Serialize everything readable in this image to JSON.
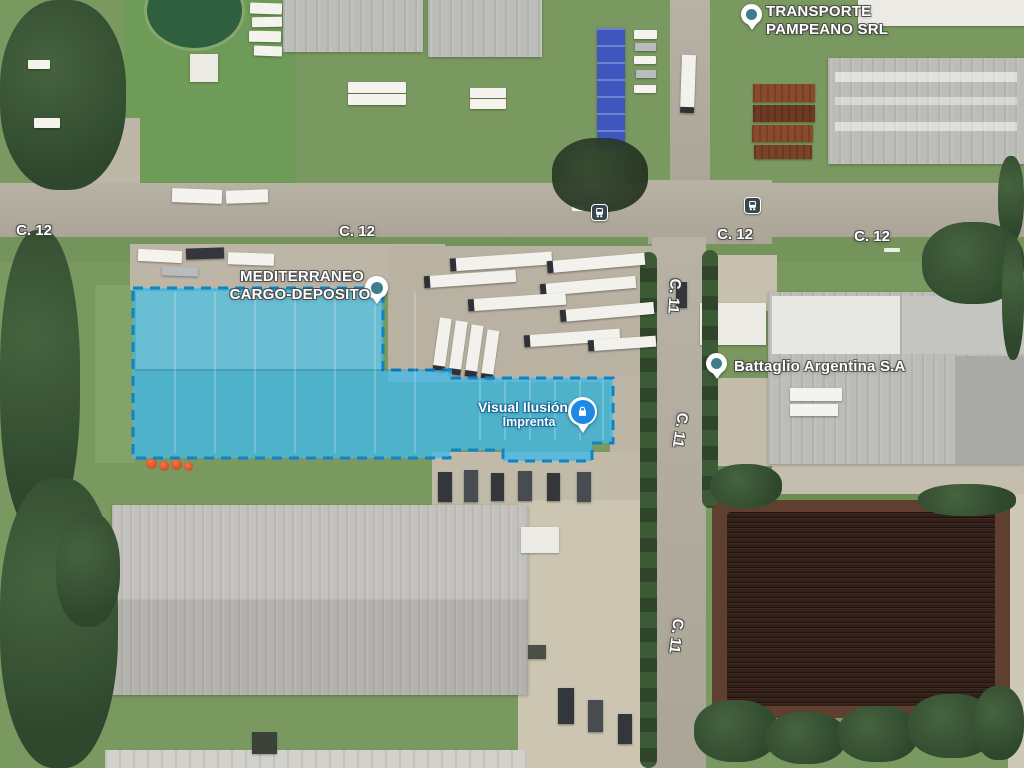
{
  "selection": {
    "fill": "#41b8e9",
    "stroke": "#0d84c6",
    "top_tint": "rgba(255,255,255,0.16)"
  },
  "places": {
    "transporte": {
      "line1": "TRANSPORTE",
      "line2": "PAMPEANO SRL"
    },
    "mediterraneo": {
      "line1": "MEDITERRANEO",
      "line2": "CARGO-DEPOSITO"
    },
    "battaglio": {
      "name": "Battaglio Argentina S.A"
    },
    "visual_ilusion": {
      "line1": "Visual Ilusión",
      "line2": "Imprenta"
    }
  },
  "roads": {
    "c12": "C. 12",
    "c11": "C. 11"
  },
  "icons": {
    "bus_stop": "bus-stop-icon",
    "lock": "lock-icon",
    "poi_pin": "map-pin-icon"
  },
  "colors": {
    "pin_teal": "#3f7d8d",
    "pin_blue": "#1e88e5",
    "bus_bg": "#37474f"
  }
}
